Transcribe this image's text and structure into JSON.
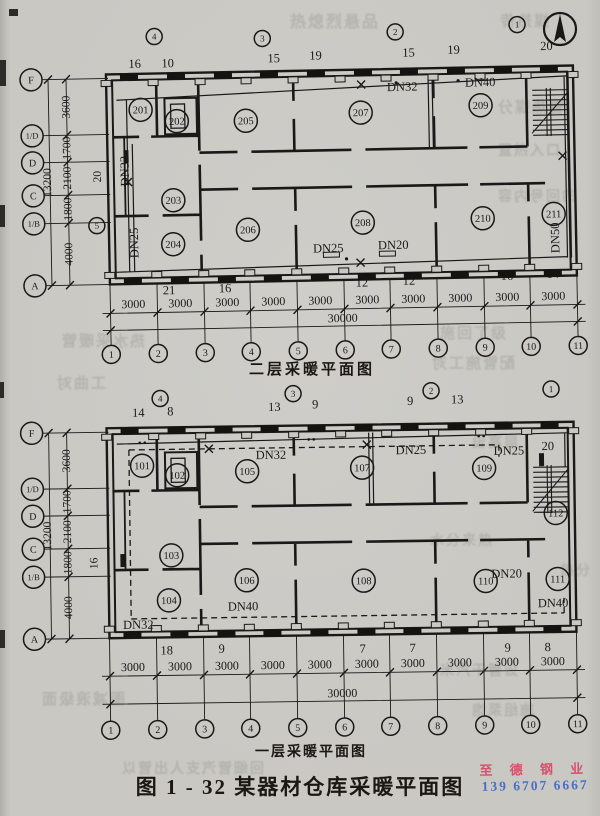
{
  "page": {
    "figure_caption": "图 1 - 32    某器材仓库采暖平面图",
    "watermark": {
      "line1": "至 德 钢 业",
      "line2": "139 6707 6667",
      "color1": "#d4526b",
      "color2": "#4a6fc8"
    },
    "north_arrow": "north-arrow"
  },
  "plans": [
    {
      "caption": "二层采暖平面图",
      "row_bubbles": [
        {
          "t": "F",
          "x": 33,
          "y": 74
        },
        {
          "t": "1/D",
          "x": 33,
          "y": 130
        },
        {
          "t": "D",
          "x": 33,
          "y": 157
        },
        {
          "t": "C",
          "x": 33,
          "y": 190
        },
        {
          "t": "1/B",
          "x": 33,
          "y": 218
        },
        {
          "t": "A",
          "x": 33,
          "y": 280
        }
      ],
      "row_dims": [
        {
          "t": "3600",
          "x": 71,
          "y": 102
        },
        {
          "t": "1700",
          "x": 71,
          "y": 143
        },
        {
          "t": "2100",
          "x": 71,
          "y": 173
        },
        {
          "t": "1800",
          "x": 71,
          "y": 204
        },
        {
          "t": "4000",
          "x": 71,
          "y": 249
        }
      ],
      "left_total": {
        "t": "13200",
        "x": 51,
        "y": 177
      },
      "aux_bubble": {
        "t": "5",
        "x": 96,
        "y": 221
      },
      "riser_bubbles": [
        {
          "t": "4",
          "x": 157,
          "y": 33
        },
        {
          "t": "3",
          "x": 265,
          "y": 37
        },
        {
          "t": "2",
          "x": 398,
          "y": 33
        },
        {
          "t": "1",
          "x": 520,
          "y": 28
        }
      ],
      "counts_top": [
        {
          "t": "16",
          "x": 137,
          "y": 64
        },
        {
          "t": "10",
          "x": 170,
          "y": 64
        },
        {
          "t": "15",
          "x": 276,
          "y": 61
        },
        {
          "t": "19",
          "x": 318,
          "y": 59
        },
        {
          "t": "15",
          "x": 411,
          "y": 58
        },
        {
          "t": "19",
          "x": 456,
          "y": 56
        },
        {
          "t": "20",
          "x": 549,
          "y": 54
        }
      ],
      "counts_bottom": [
        {
          "t": "21",
          "x": 167,
          "y": 291
        },
        {
          "t": "16",
          "x": 223,
          "y": 290
        },
        {
          "t": "12",
          "x": 360,
          "y": 287
        },
        {
          "t": "12",
          "x": 407,
          "y": 286
        },
        {
          "t": "16",
          "x": 505,
          "y": 283
        },
        {
          "t": "14",
          "x": 551,
          "y": 282
        }
      ],
      "rot_counts": [
        {
          "t": "20",
          "x": 101,
          "y": 172
        }
      ],
      "bay_dim": "3000",
      "bay_label_xs": [
        131,
        178,
        225,
        271,
        318,
        365,
        411,
        458,
        505,
        551
      ],
      "total_dim": {
        "t": "30000",
        "x": 340,
        "y": 322
      },
      "col_bubbles": [
        "1",
        "2",
        "3",
        "4",
        "5",
        "6",
        "7",
        "8",
        "9",
        "10",
        "11"
      ],
      "rooms": [
        {
          "t": "201",
          "x": 142,
          "y": 106
        },
        {
          "t": "202",
          "x": 178,
          "y": 118
        },
        {
          "t": "205",
          "x": 247,
          "y": 119
        },
        {
          "t": "207",
          "x": 362,
          "y": 113
        },
        {
          "t": "209",
          "x": 482,
          "y": 108
        },
        {
          "t": "203",
          "x": 173,
          "y": 197
        },
        {
          "t": "204",
          "x": 172,
          "y": 241
        },
        {
          "t": "206",
          "x": 247,
          "y": 228
        },
        {
          "t": "208",
          "x": 362,
          "y": 223
        },
        {
          "t": "210",
          "x": 482,
          "y": 221
        },
        {
          "t": "211",
          "x": 553,
          "y": 218
        }
      ],
      "pipe_labels": [
        {
          "t": "DN32",
          "x": 404,
          "y": 92
        },
        {
          "t": "DN40",
          "x": 482,
          "y": 89
        },
        {
          "t": "DN25",
          "x": 327,
          "y": 252
        },
        {
          "t": "DN20",
          "x": 392,
          "y": 250
        },
        {
          "t": "DN32",
          "x": 129,
          "y": 167,
          "rot": -90
        },
        {
          "t": "DN25",
          "x": 137,
          "y": 239,
          "rot": -90
        },
        {
          "t": "DN50",
          "x": 558,
          "y": 242,
          "rot": -90
        }
      ]
    },
    {
      "caption": "一层采暖平面图",
      "row_bubbles": [
        {
          "t": "F",
          "x": 33,
          "y": 429
        },
        {
          "t": "1/D",
          "x": 33,
          "y": 485
        },
        {
          "t": "D",
          "x": 33,
          "y": 512
        },
        {
          "t": "C",
          "x": 33,
          "y": 545
        },
        {
          "t": "1/B",
          "x": 33,
          "y": 573
        },
        {
          "t": "A",
          "x": 33,
          "y": 635
        }
      ],
      "row_dims": [
        {
          "t": "3600",
          "x": 71,
          "y": 457
        },
        {
          "t": "1700",
          "x": 71,
          "y": 498
        },
        {
          "t": "2100",
          "x": 71,
          "y": 528
        },
        {
          "t": "1800",
          "x": 71,
          "y": 559
        },
        {
          "t": "4000",
          "x": 71,
          "y": 604
        }
      ],
      "left_total": {
        "t": "13200",
        "x": 51,
        "y": 532
      },
      "riser_bubbles": [
        {
          "t": "4",
          "x": 162,
          "y": 396
        },
        {
          "t": "3",
          "x": 295,
          "y": 393
        },
        {
          "t": "2",
          "x": 433,
          "y": 392
        },
        {
          "t": "1",
          "x": 553,
          "y": 392
        }
      ],
      "counts_top": [
        {
          "t": "14",
          "x": 140,
          "y": 414
        },
        {
          "t": "8",
          "x": 172,
          "y": 413
        },
        {
          "t": "13",
          "x": 276,
          "y": 410
        },
        {
          "t": "9",
          "x": 317,
          "y": 408
        },
        {
          "t": "9",
          "x": 412,
          "y": 406
        },
        {
          "t": "13",
          "x": 459,
          "y": 405
        }
      ],
      "counts_bottom": [
        {
          "t": "18",
          "x": 165,
          "y": 652
        },
        {
          "t": "9",
          "x": 220,
          "y": 651
        },
        {
          "t": "7",
          "x": 361,
          "y": 653
        },
        {
          "t": "7",
          "x": 411,
          "y": 653
        },
        {
          "t": "9",
          "x": 506,
          "y": 654
        },
        {
          "t": "8",
          "x": 546,
          "y": 654
        }
      ],
      "rot_counts": [
        {
          "t": "16",
          "x": 97,
          "y": 560
        }
      ],
      "bay_dim": "3000",
      "bay_label_xs": [
        131,
        178,
        225,
        271,
        318,
        365,
        411,
        458,
        505,
        551
      ],
      "total_dim": {
        "t": "30000",
        "x": 340,
        "y": 697
      },
      "col_bubbles": [
        "1",
        "2",
        "3",
        "4",
        "5",
        "6",
        "7",
        "8",
        "9",
        "10",
        "11"
      ],
      "rooms": [
        {
          "t": "101",
          "x": 143,
          "y": 463
        },
        {
          "t": "102",
          "x": 178,
          "y": 473
        },
        {
          "t": "105",
          "x": 248,
          "y": 470
        },
        {
          "t": "107",
          "x": 363,
          "y": 468
        },
        {
          "t": "109",
          "x": 485,
          "y": 470
        },
        {
          "t": "112",
          "x": 556,
          "y": 516
        },
        {
          "t": "103",
          "x": 171,
          "y": 553
        },
        {
          "t": "104",
          "x": 168,
          "y": 598
        },
        {
          "t": "106",
          "x": 246,
          "y": 579
        },
        {
          "t": "108",
          "x": 363,
          "y": 581
        },
        {
          "t": "110",
          "x": 485,
          "y": 583
        },
        {
          "t": "111",
          "x": 557,
          "y": 582
        }
      ],
      "pipe_labels": [
        {
          "t": "DN32",
          "x": 272,
          "y": 458
        },
        {
          "t": "DN25",
          "x": 412,
          "y": 455
        },
        {
          "t": "DN25",
          "x": 510,
          "y": 457
        },
        {
          "t": "20",
          "x": 549,
          "y": 453
        },
        {
          "t": "DN20",
          "x": 506,
          "y": 580
        },
        {
          "t": "DN40",
          "x": 242,
          "y": 609
        },
        {
          "t": "DN40",
          "x": 552,
          "y": 610
        },
        {
          "t": "DN32",
          "x": 137,
          "y": 626
        }
      ]
    }
  ],
  "bleed_text": [
    {
      "t": "热熄烈悬品",
      "x": 290,
      "y": 8,
      "s": 16
    },
    {
      "t": "媒热传",
      "x": 498,
      "y": 10,
      "s": 15
    },
    {
      "t": "管热媒分",
      "x": 496,
      "y": 96,
      "s": 15
    },
    {
      "t": "置热入口",
      "x": 498,
      "y": 140,
      "s": 14
    },
    {
      "t": "的回号内容",
      "x": 496,
      "y": 186,
      "s": 14
    },
    {
      "t": "热水采暖管",
      "x": 60,
      "y": 330,
      "s": 15
    },
    {
      "t": "施回了级",
      "x": 440,
      "y": 322,
      "s": 15
    },
    {
      "t": "配管施工对",
      "x": 430,
      "y": 352,
      "s": 15
    },
    {
      "t": "层高设",
      "x": 470,
      "y": 432,
      "s": 14
    },
    {
      "t": "水分来热",
      "x": 430,
      "y": 530,
      "s": 14
    },
    {
      "t": "工曲对",
      "x": 55,
      "y": 372,
      "s": 15
    },
    {
      "t": "图减浪级面",
      "x": 40,
      "y": 688,
      "s": 15
    },
    {
      "t": "米汽干管设",
      "x": 440,
      "y": 660,
      "s": 14
    },
    {
      "t": "回细管汽支人出管以",
      "x": 120,
      "y": 758,
      "s": 14
    },
    {
      "t": "施组泵饱",
      "x": 470,
      "y": 700,
      "s": 14
    },
    {
      "t": "热分",
      "x": 560,
      "y": 560,
      "s": 14
    }
  ]
}
